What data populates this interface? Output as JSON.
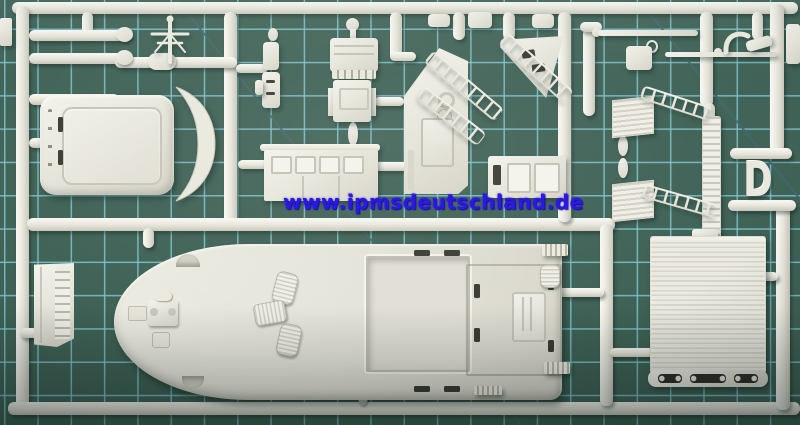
{
  "scene": {
    "type": "photograph",
    "subject": "Injection-molded model kit sprue with light-grey ship parts lying on a green self-healing cutting mat",
    "watermark_text": "www.ipmsdeutschland.de",
    "sprue_letter": "D",
    "parts_inventory": [
      "main deck with cargo-hatch opening and bow fittings",
      "cabin roof panel",
      "curved coaming strip",
      "wheelhouse side wall with windows",
      "bridge front bulkhead with door and portholes",
      "triangular platform",
      "window box structure",
      "mast with crosstrees",
      "searchlight and binnacle parts",
      "railing ladders",
      "louvered hatches",
      "corrugated deckhouse roof with railing base",
      "ladder strip",
      "booms and yards",
      "side louver panel",
      "cowl ventilators"
    ]
  },
  "colors": {
    "mat_base": "#3f6156",
    "mat_shadowed": "#2d4840",
    "grid_line": "#7fc3cf",
    "plastic_highlight": "#f5f4ee",
    "plastic_base": "#e6e5dc",
    "plastic_shadow": "#c8c6bb",
    "watermark_blue": "#2a18e4"
  }
}
